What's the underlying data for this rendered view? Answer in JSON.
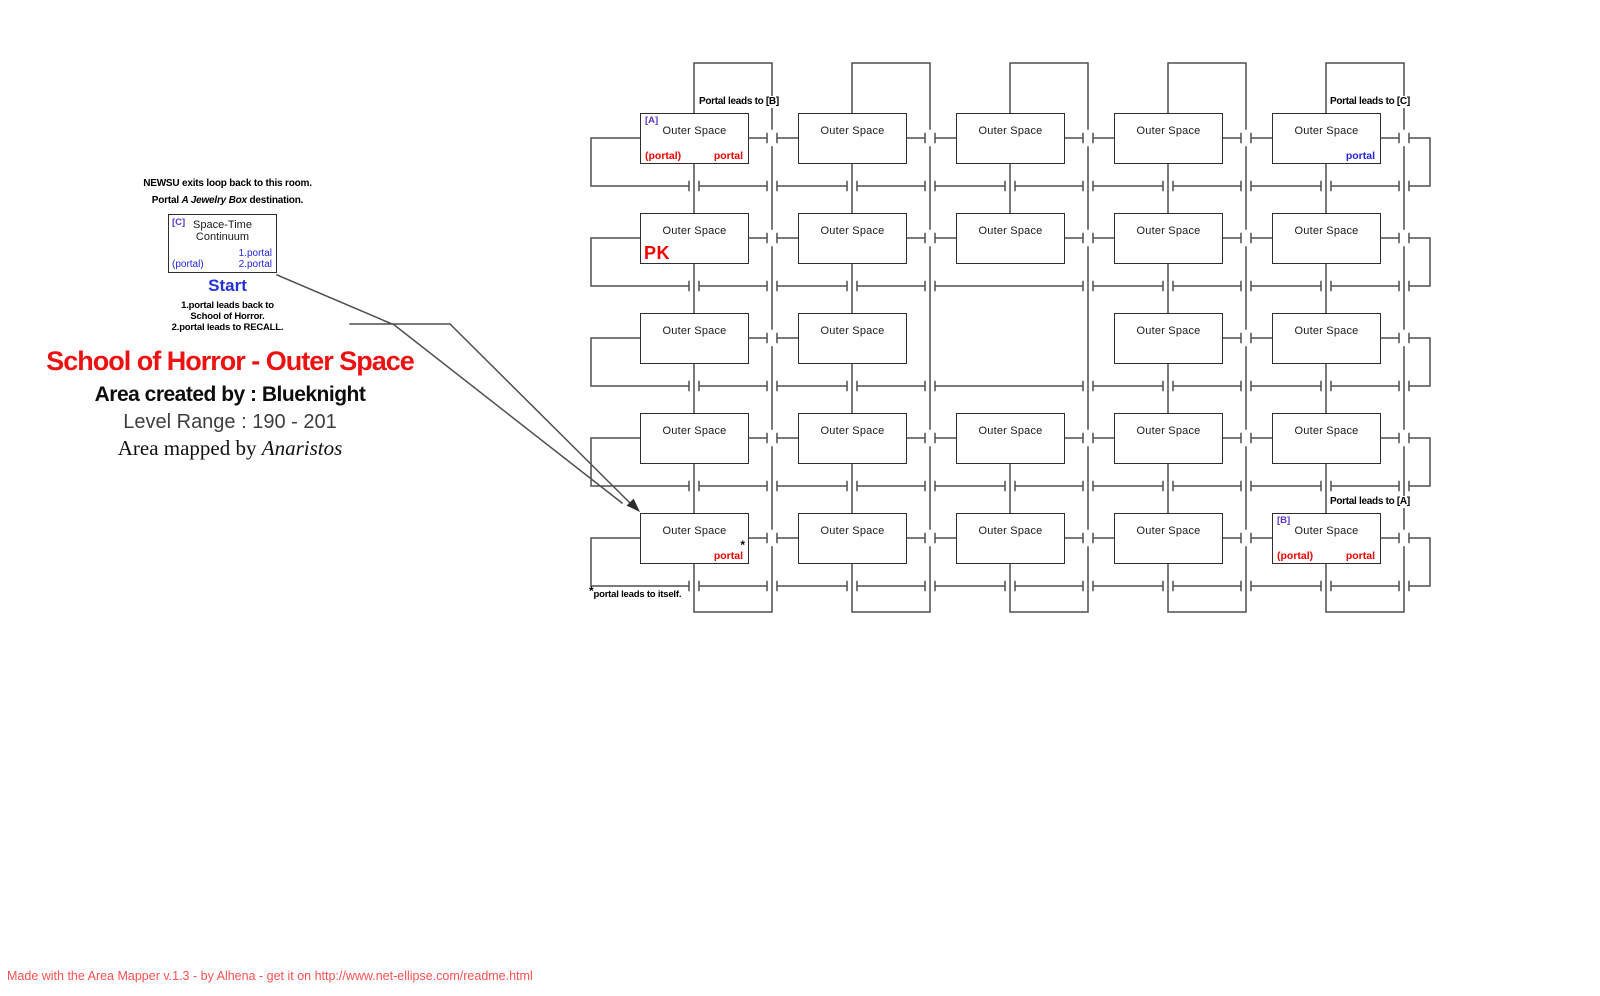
{
  "colors": {
    "title_red": "#ee1111",
    "portal_red": "#f20000",
    "portal_blue": "#2424e0",
    "tag_purple": "#5a35cc",
    "start_blue": "#2433d6",
    "footer_red": "#ff5151",
    "line_gray": "#4f4f4f",
    "box_border": "#2d2d2d"
  },
  "legend": {
    "note1": "NEWSU exits loop back to this room.",
    "note2_prefix": "Portal ",
    "note2_italic": "A Jewelry Box",
    "note2_suffix": " destination.",
    "room": {
      "tag": "[C]",
      "name_line1": "Space-Time",
      "name_line2": "Continuum",
      "portal1": "1.portal",
      "portal_paren": "(portal)",
      "portal2": "2.portal"
    },
    "start_label": "Start",
    "note3_line1": "1.portal leads back to",
    "note3_line2": "School of Horror.",
    "note3_line3": "2.portal leads to RECALL."
  },
  "title": {
    "main": "School of Horror - Outer Space",
    "created": "Area created by : Blueknight",
    "level_range": "Level Range : 190 - 201",
    "mapped_prefix": "Area mapped by ",
    "mapped_name": "Anaristos"
  },
  "map": {
    "annotations": [
      {
        "id": "top-left",
        "text": "Portal leads to [B]"
      },
      {
        "id": "top-right",
        "text": "Portal leads to [C]"
      },
      {
        "id": "bottom-right",
        "text": "Portal leads to [A]"
      }
    ],
    "footnote_star": "*",
    "footnote_text": "portal leads to itself.",
    "rooms": [
      {
        "row": 1,
        "col": 1,
        "label": "Outer Space",
        "tag": "[A]",
        "bottom_left": "(portal)",
        "bottom_left_color": "red",
        "bottom_right": "portal",
        "bottom_right_color": "red"
      },
      {
        "row": 1,
        "col": 2,
        "label": "Outer Space"
      },
      {
        "row": 1,
        "col": 3,
        "label": "Outer Space"
      },
      {
        "row": 1,
        "col": 4,
        "label": "Outer Space"
      },
      {
        "row": 1,
        "col": 5,
        "label": "Outer Space",
        "bottom_right": "portal",
        "bottom_right_color": "blue"
      },
      {
        "row": 2,
        "col": 1,
        "label": "Outer Space",
        "badge": "PK"
      },
      {
        "row": 2,
        "col": 2,
        "label": "Outer Space"
      },
      {
        "row": 2,
        "col": 3,
        "label": "Outer Space"
      },
      {
        "row": 2,
        "col": 4,
        "label": "Outer Space"
      },
      {
        "row": 2,
        "col": 5,
        "label": "Outer Space"
      },
      {
        "row": 3,
        "col": 1,
        "label": "Outer Space"
      },
      {
        "row": 3,
        "col": 2,
        "label": "Outer Space"
      },
      {
        "row": 3,
        "col": 4,
        "label": "Outer Space"
      },
      {
        "row": 3,
        "col": 5,
        "label": "Outer Space"
      },
      {
        "row": 4,
        "col": 1,
        "label": "Outer Space"
      },
      {
        "row": 4,
        "col": 2,
        "label": "Outer Space"
      },
      {
        "row": 4,
        "col": 3,
        "label": "Outer Space"
      },
      {
        "row": 4,
        "col": 4,
        "label": "Outer Space"
      },
      {
        "row": 4,
        "col": 5,
        "label": "Outer Space"
      },
      {
        "row": 5,
        "col": 1,
        "label": "Outer Space",
        "bottom_right": "portal",
        "bottom_right_color": "red",
        "footnote_mark": "*"
      },
      {
        "row": 5,
        "col": 2,
        "label": "Outer Space"
      },
      {
        "row": 5,
        "col": 3,
        "label": "Outer Space"
      },
      {
        "row": 5,
        "col": 4,
        "label": "Outer Space"
      },
      {
        "row": 5,
        "col": 5,
        "label": "Outer Space",
        "tag": "[B]",
        "bottom_left": "(portal)",
        "bottom_left_color": "red",
        "bottom_right": "portal",
        "bottom_right_color": "red"
      }
    ]
  },
  "footer": {
    "credit": "Made with the Area Mapper v.1.3 - by Alhena - get it on http://www.net-ellipse.com/readme.html"
  }
}
